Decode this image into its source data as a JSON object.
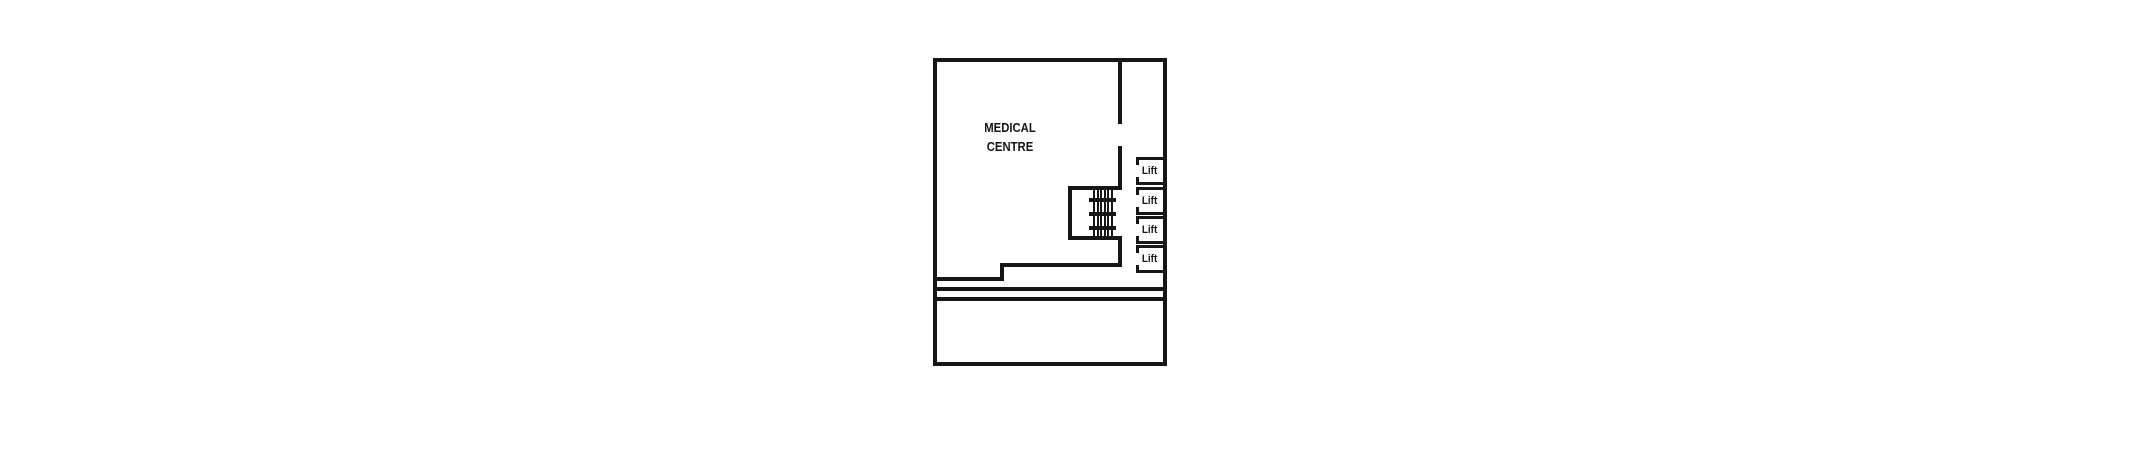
{
  "page": {
    "background": "#ffffff"
  },
  "plan": {
    "line_color": "#161616",
    "room": {
      "name_line1": "MEDICAL",
      "name_line2": "CENTRE"
    },
    "lifts": [
      {
        "label": "Lift"
      },
      {
        "label": "Lift"
      },
      {
        "label": "Lift"
      },
      {
        "label": "Lift"
      }
    ],
    "symbols": {
      "staircase": "staircase-symbol"
    }
  }
}
